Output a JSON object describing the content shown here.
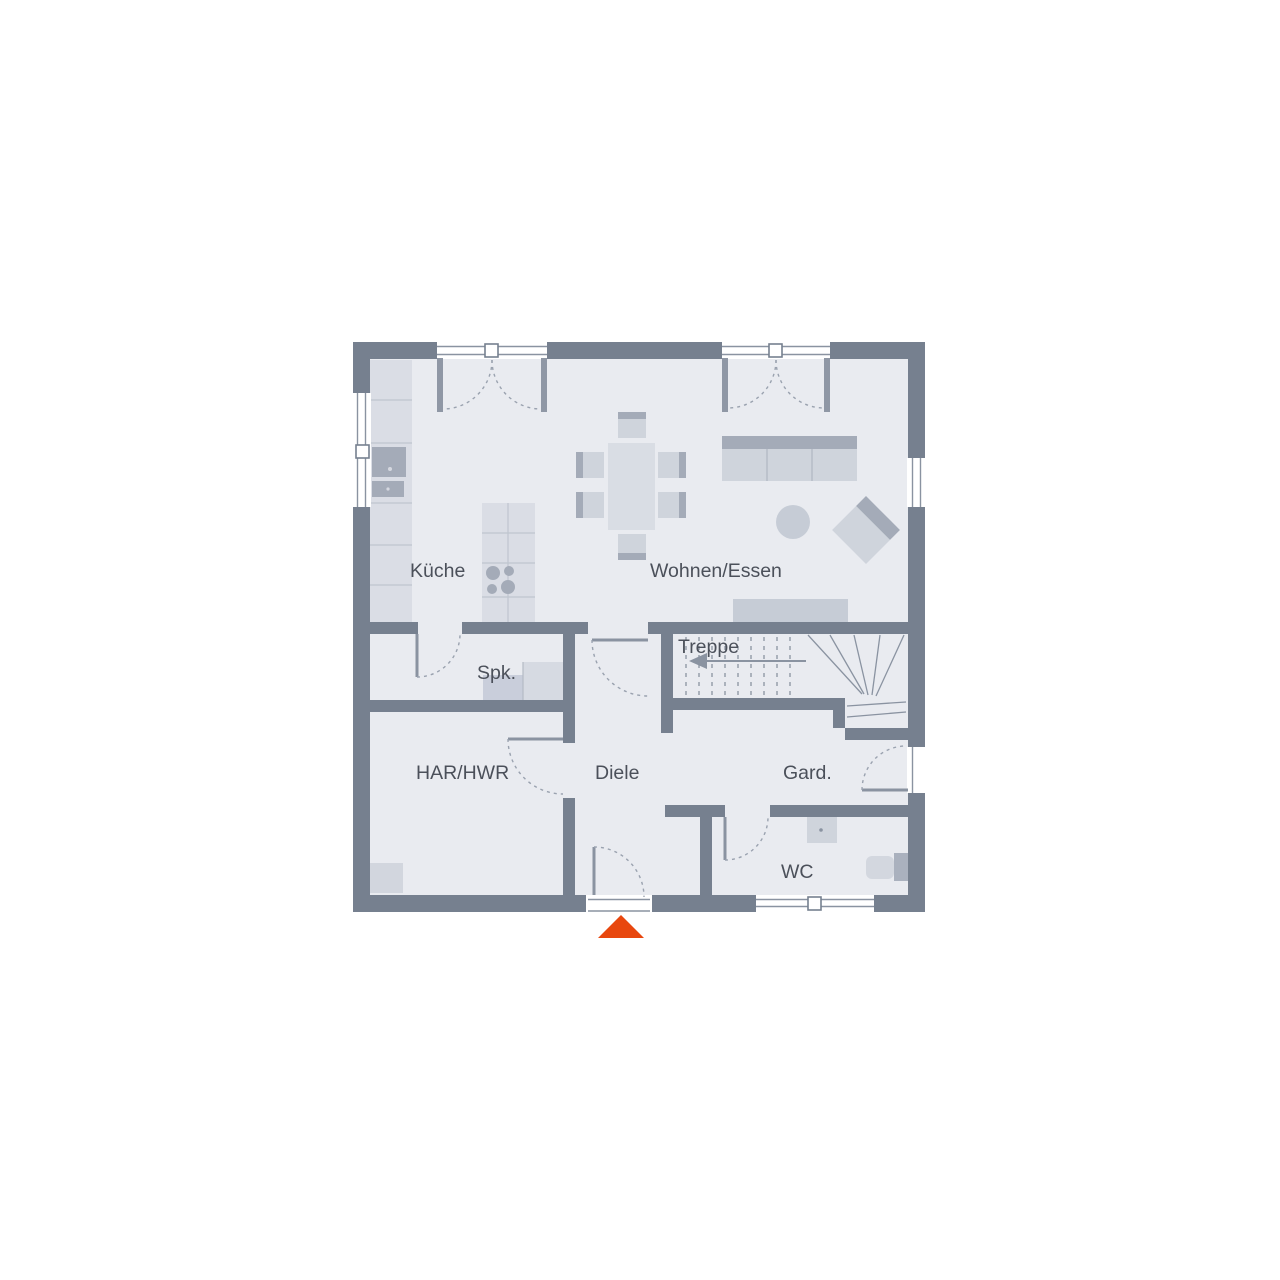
{
  "plan": {
    "type": "floor-plan",
    "title": "Erdgeschoss Grundriss",
    "rooms": {
      "kitchen": {
        "label": "Küche"
      },
      "living_dining": {
        "label": "Wohnen/Essen"
      },
      "pantry": {
        "label": "Spk."
      },
      "stairs": {
        "label": "Treppe"
      },
      "utility": {
        "label": "HAR/HWR"
      },
      "hallway": {
        "label": "Diele"
      },
      "wardrobe": {
        "label": "Gard."
      },
      "wc": {
        "label": "WC"
      }
    },
    "colors": {
      "wall": "#76808f",
      "floor": "#e9ebf0",
      "furniture_light": "#cfd4dc",
      "furniture_dark": "#a4abb8",
      "counter": "#dadde5",
      "line": "#8a93a1",
      "label_text": "#4b505a",
      "entrance_marker": "#e8470e"
    },
    "markers": {
      "entrance": "up-triangle"
    }
  }
}
